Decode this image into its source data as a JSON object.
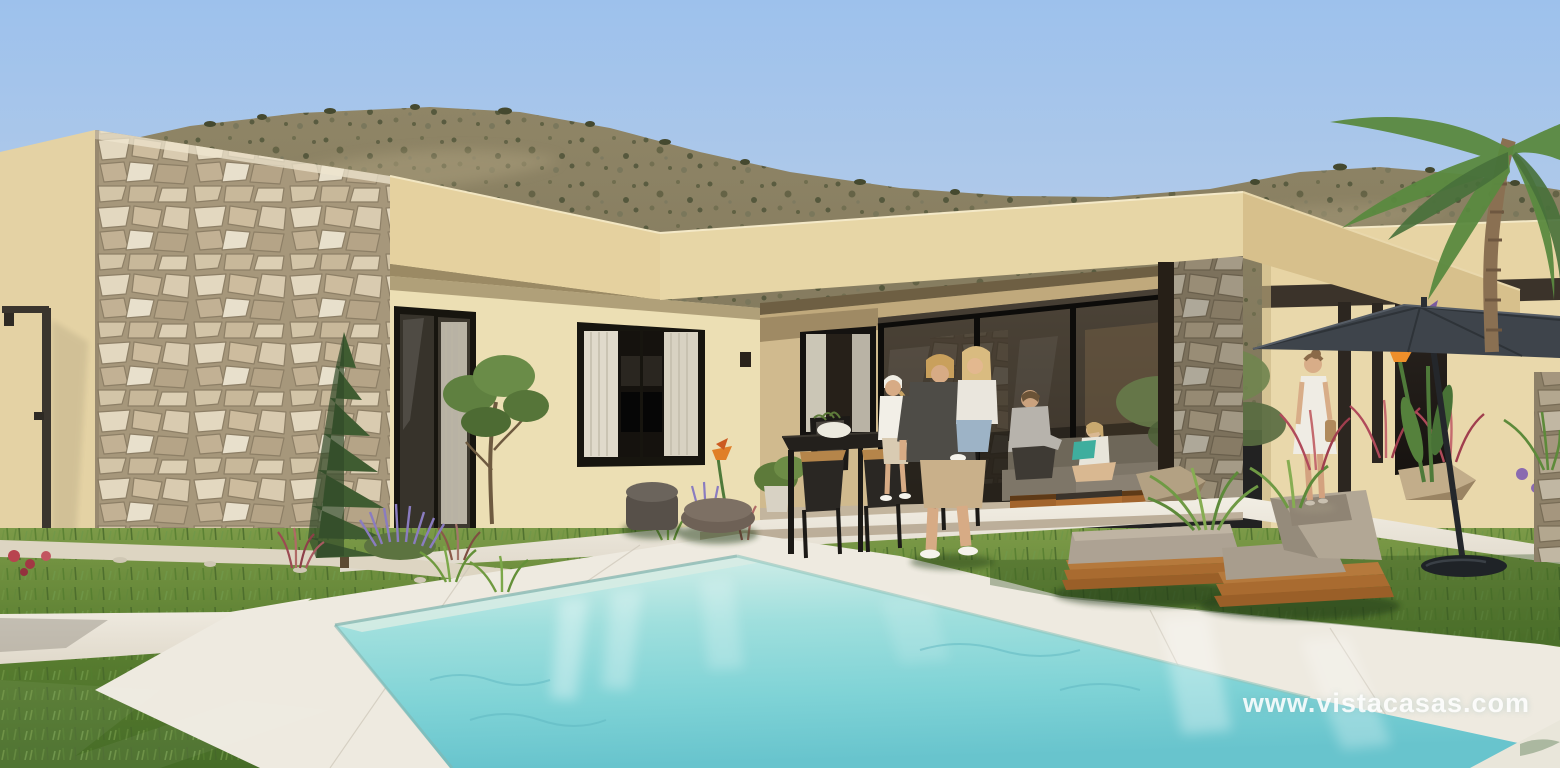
{
  "image": {
    "kind": "photorealistic 3D architectural render",
    "scene": "Single-storey modern villa with natural stone feature wall, covered terrace with family, landscaped garden, sun loungers, parasol and rectangular swimming pool in front of scrub-covered hills",
    "width_px": 1560,
    "height_px": 768
  },
  "watermark": {
    "text": "www.vistacasas.com",
    "color": "#ffffff"
  },
  "palette": {
    "sky_top": "#9dc1ec",
    "sky_horizon": "#c8d7e9",
    "hill_base": "#948a6a",
    "hill_scrub": "#52563a",
    "stucco_sunlit": "#ecdcb0",
    "stucco_shadow": "#d7c08c",
    "stone_grout": "#a6977b",
    "stone_light": "#e8e0cc",
    "glass_frame": "#17150f",
    "terrace_interior": "#241f19",
    "grass_light": "#7c9a48",
    "grass_dark": "#466c27",
    "paving": "#eeeae0",
    "pool_far": "#d6efe9",
    "pool_near": "#68c4cd",
    "wood": "#b5793c",
    "cushion": "#ada293",
    "parasol": "#3e444b"
  },
  "objects": {
    "house": [
      "left wall",
      "stone feature wall",
      "roof fascia",
      "sliding glass door",
      "curtained window",
      "covered terrace",
      "glass rear wall",
      "stone pillar",
      "right wing with pergola posts",
      "wall sconce",
      "outdoor shower"
    ],
    "people": [
      "man holding child",
      "woman at dining table",
      "man seated on sofa",
      "girl reading teal book",
      "woman in white dress walking"
    ],
    "furniture": [
      "black dining table with planter bowl",
      "four dining chairs",
      "grey outdoor sofa with wood plinth",
      "coffee tables",
      "two fabric poufs",
      "flat sun lounger",
      "reclined sun lounger with pillow",
      "anthracite parasol with base"
    ],
    "garden": [
      "lawn",
      "white paving and pool deck",
      "swimming pool",
      "conifer tree",
      "small ornamental tree",
      "lavender",
      "red fountain grasses",
      "ferns",
      "bird of paradise flowers",
      "rocks",
      "palm tree",
      "gravel bed"
    ]
  }
}
